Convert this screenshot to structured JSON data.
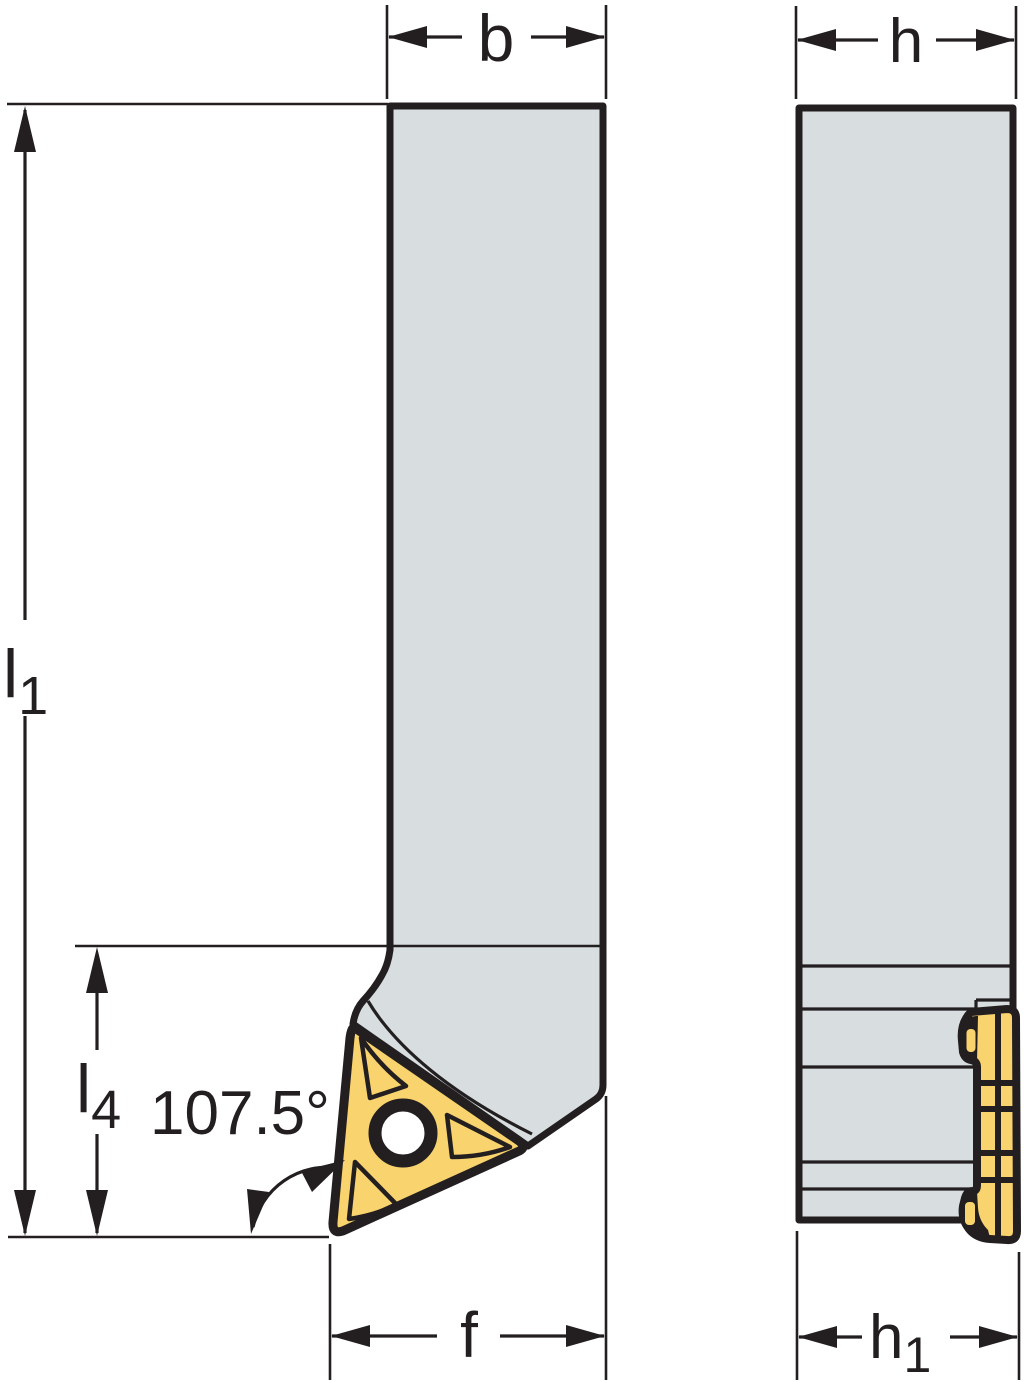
{
  "colors": {
    "line": "#231f20",
    "holder_fill": "#d8dedf",
    "insert_fill": "#f9d36e",
    "hole_fill": "#ffffff",
    "background": "#ffffff"
  },
  "dimensions": {
    "b": {
      "label": "b"
    },
    "h": {
      "label": "h"
    },
    "l1": {
      "main": "l",
      "sub": "1"
    },
    "l4": {
      "main": "l",
      "sub": "4"
    },
    "angle": {
      "label": "107.5°"
    },
    "f": {
      "label": "f"
    },
    "h1": {
      "main": "h",
      "sub": "1"
    }
  }
}
